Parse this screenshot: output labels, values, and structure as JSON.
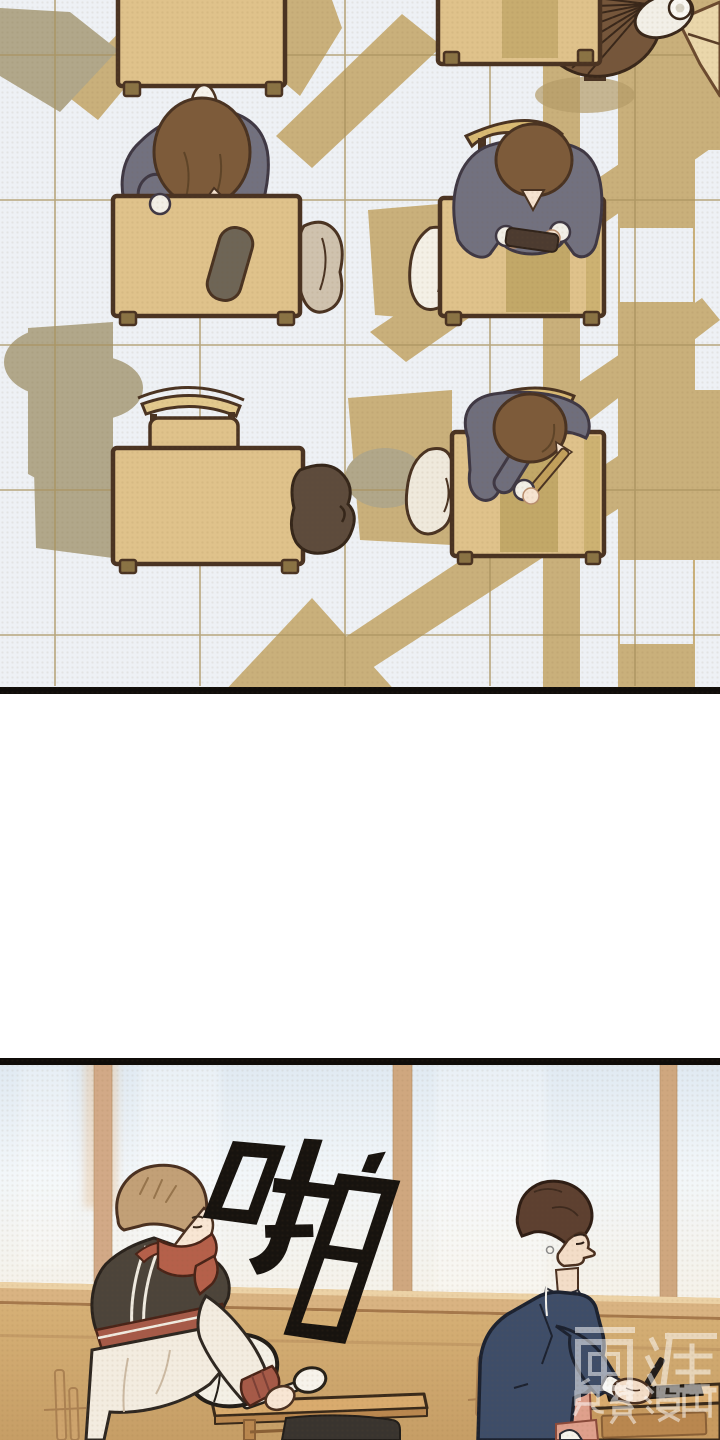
{
  "page": {
    "kind": "webtoon comic page",
    "background_color": "#ffffff"
  },
  "panels": {
    "top": {
      "description": "Overhead view of a classroom: students seated at wooden desks on a tiled floor, long afternoon window shadows, an electric fan mounted in the top-right corner",
      "border_color": "#0f0c09"
    },
    "bottom": {
      "description": "Classroom beside the windows: a student in a letterman jacket leans over a desk with a white bag while a student in a navy blazer stands writing at his desk",
      "border_color": "#0f0c09",
      "sfx": {
        "text": "啪",
        "color": "#17130f",
        "rotation_deg": 16
      },
      "watermark": {
        "title": "画涯",
        "subtitle": "免费漫画",
        "color": "#ffffff",
        "opacity": 0.52
      }
    }
  },
  "palette": {
    "floor_tile": "#eef1f5",
    "tile_line": "#a9935f",
    "window_light_shadow": "#c9b07b",
    "furniture_shadow": "#b1a78a",
    "desk_wood": "#dfc28b",
    "desk_outline": "#4a3322",
    "blazer_gray": "#72717f",
    "hair_brown": "#7d5b3a",
    "glass_blue": "#dfe9f2",
    "window_frame_tan": "#d2a987",
    "wall_tan": "#d0a873",
    "jacket_dark": "#4c443a",
    "jacket_accent_red": "#b5604a",
    "navy_blazer": "#3e4d68",
    "sweater_salmon": "#dfa08c"
  }
}
